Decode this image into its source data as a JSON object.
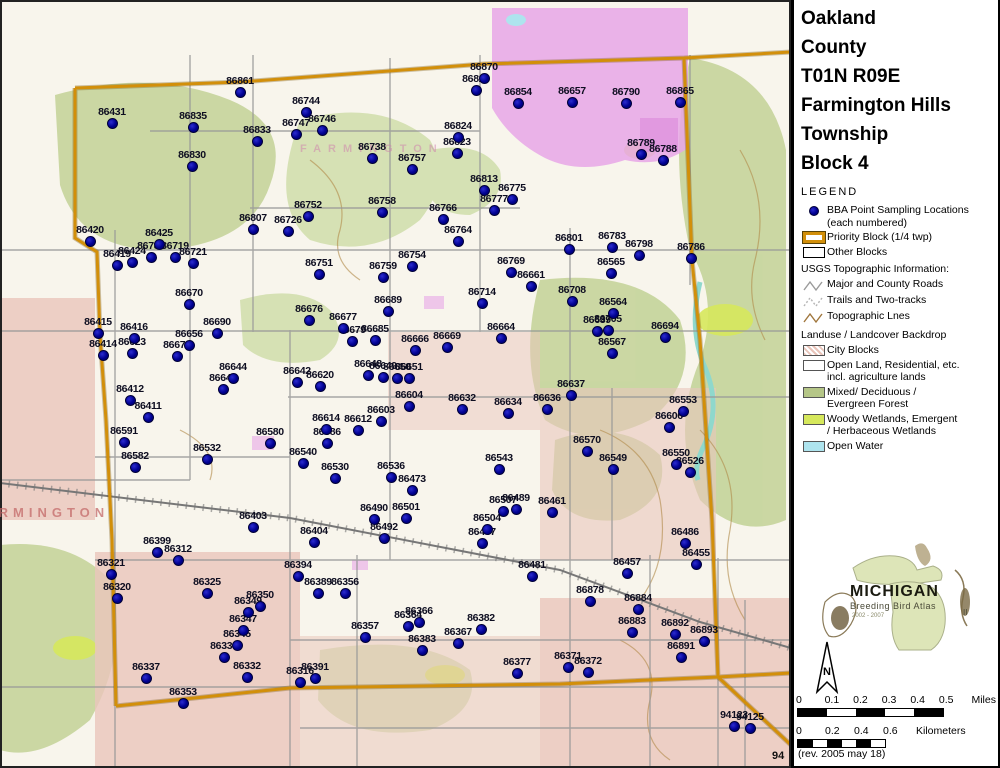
{
  "panel": {
    "title_lines": [
      "Oakland",
      "County",
      "T01N R09E",
      "Farmington Hills",
      "Township",
      "Block 4"
    ],
    "legend_heading": "LEGEND",
    "legend": {
      "items": [
        {
          "icon": "bba-point-dot",
          "lines": [
            "BBA Point Sampling Locations",
            "(each numbered)"
          ]
        },
        {
          "icon": "priority-block-swatch",
          "lines": [
            "Priority Block (1/4 twp)",
            ""
          ]
        },
        {
          "icon": "other-block-swatch",
          "lines": [
            "Other Blocks",
            ""
          ]
        }
      ]
    },
    "usgs": {
      "heading": "USGS Topographic Information:",
      "items": [
        {
          "icon": "major-roads-line",
          "label": "Major and County Roads"
        },
        {
          "icon": "trails-line",
          "label": "Trails and Two-tracks"
        },
        {
          "icon": "topographic-line",
          "label": "Topographic Lnes"
        }
      ]
    },
    "landuse": {
      "heading": "Landuse / Landcover Backdrop",
      "items": [
        {
          "swatch": "#e9c4ba",
          "pattern": "hatch",
          "lines": [
            "City Blocks",
            ""
          ]
        },
        {
          "swatch": "#ffffff",
          "pattern": "",
          "lines": [
            "Open Land, Residential, etc.",
            "incl. agriculture lands"
          ]
        },
        {
          "swatch": "#b5c687",
          "pattern": "",
          "lines": [
            "Mixed/ Deciduous /",
            "Evergreen Forest"
          ]
        },
        {
          "swatch": "#d6e85c",
          "pattern": "",
          "lines": [
            "Woody Wetlands, Emergent",
            "/ Herbaceous Wetlands"
          ]
        },
        {
          "swatch": "#aee4ee",
          "pattern": "",
          "lines": [
            "Open Water",
            ""
          ]
        }
      ]
    },
    "logo": {
      "name": "MICHIGAN",
      "sub": "Breeding Bird Atlas",
      "years": "2002 - 2007",
      "numeral": "II"
    },
    "north_label": "N",
    "scales": {
      "miles": {
        "ticks": [
          "0",
          "0.1",
          "0.2",
          "0.3",
          "0.4",
          "0.5"
        ],
        "unit": "Miles",
        "segments": 5
      },
      "km": {
        "ticks": [
          "0",
          "0.2",
          "0.4",
          "0.6"
        ],
        "unit": "Kilometers",
        "segments": 6
      }
    },
    "rev_text": "(rev. 2005 may 18)"
  },
  "map": {
    "colors": {
      "priority_border": "#d28f0a",
      "point_fill": "#000090",
      "forest": "#c5d49b",
      "wetland": "#d6e85c",
      "city": "#e9c4ba",
      "subdivision": "#e7a6e7",
      "water": "#aee4ee"
    },
    "town_label": "FARMINGTON",
    "town_label2": "FARMINGTON",
    "corner_label": "94",
    "points": [
      [
        "86431",
        112,
        123
      ],
      [
        "86861",
        240,
        92
      ],
      [
        "86835",
        193,
        127
      ],
      [
        "86833",
        257,
        141
      ],
      [
        "86744",
        306,
        112
      ],
      [
        "86746",
        322,
        130
      ],
      [
        "86747",
        296,
        134
      ],
      [
        "86738",
        372,
        158
      ],
      [
        "86830",
        192,
        166
      ],
      [
        "86870",
        484,
        78
      ],
      [
        "86826",
        476,
        90
      ],
      [
        "86854",
        518,
        103
      ],
      [
        "86657",
        572,
        102
      ],
      [
        "86790",
        626,
        103
      ],
      [
        "86865",
        680,
        102
      ],
      [
        "86824",
        458,
        137
      ],
      [
        "86757",
        412,
        169
      ],
      [
        "86823",
        457,
        153
      ],
      [
        "86789",
        641,
        154
      ],
      [
        "86788",
        663,
        160
      ],
      [
        "86813",
        484,
        190
      ],
      [
        "86775",
        512,
        199
      ],
      [
        "86777",
        494,
        210
      ],
      [
        "86766",
        443,
        219
      ],
      [
        "86764",
        458,
        241
      ],
      [
        "86758",
        382,
        212
      ],
      [
        "86752",
        308,
        216
      ],
      [
        "86807",
        253,
        229
      ],
      [
        "86726",
        288,
        231
      ],
      [
        "86420",
        90,
        241
      ],
      [
        "86425",
        159,
        244
      ],
      [
        "86719",
        175,
        257
      ],
      [
        "86419",
        117,
        265
      ],
      [
        "86424",
        132,
        262
      ],
      [
        "86785",
        151,
        257
      ],
      [
        "86721",
        193,
        263
      ],
      [
        "86751",
        319,
        274
      ],
      [
        "86759",
        383,
        277
      ],
      [
        "86754",
        412,
        266
      ],
      [
        "86769",
        511,
        272
      ],
      [
        "86661",
        531,
        286
      ],
      [
        "86801",
        569,
        249
      ],
      [
        "86783",
        612,
        247
      ],
      [
        "86798",
        639,
        255
      ],
      [
        "86786",
        691,
        258
      ],
      [
        "86565",
        611,
        273
      ],
      [
        "86670",
        189,
        304
      ],
      [
        "86714",
        482,
        303
      ],
      [
        "86689",
        388,
        311
      ],
      [
        "86676",
        309,
        320
      ],
      [
        "86677",
        343,
        328
      ],
      [
        "86708",
        572,
        301
      ],
      [
        "86415",
        98,
        333
      ],
      [
        "86416",
        134,
        338
      ],
      [
        "86690",
        217,
        333
      ],
      [
        "86656",
        189,
        345
      ],
      [
        "86671",
        177,
        356
      ],
      [
        "86623",
        132,
        353
      ],
      [
        "86685",
        375,
        340
      ],
      [
        "86679",
        352,
        341
      ],
      [
        "86664",
        501,
        338
      ],
      [
        "86666",
        415,
        350
      ],
      [
        "86669",
        447,
        347
      ],
      [
        "86564",
        613,
        313
      ],
      [
        "86639",
        597,
        331
      ],
      [
        "86705",
        608,
        330
      ],
      [
        "86694",
        665,
        337
      ],
      [
        "86567",
        612,
        353
      ],
      [
        "86414",
        103,
        355
      ],
      [
        "86644",
        233,
        378
      ],
      [
        "86647",
        223,
        389
      ],
      [
        "86642",
        297,
        382
      ],
      [
        "86620",
        320,
        386
      ],
      [
        "86648",
        368,
        375
      ],
      [
        "86649",
        383,
        377
      ],
      [
        "86650",
        397,
        378
      ],
      [
        "86651",
        409,
        378
      ],
      [
        "86637",
        571,
        395
      ],
      [
        "86636",
        547,
        409
      ],
      [
        "86412",
        130,
        400
      ],
      [
        "86411",
        148,
        417
      ],
      [
        "86604",
        409,
        406
      ],
      [
        "86632",
        462,
        409
      ],
      [
        "86634",
        508,
        413
      ],
      [
        "86603",
        381,
        421
      ],
      [
        "86614",
        326,
        429
      ],
      [
        "86612",
        358,
        430
      ],
      [
        "86580",
        270,
        443
      ],
      [
        "86586",
        327,
        443
      ],
      [
        "86553",
        683,
        411
      ],
      [
        "86606",
        669,
        427
      ],
      [
        "86591",
        124,
        442
      ],
      [
        "86582",
        135,
        467
      ],
      [
        "86532",
        207,
        459
      ],
      [
        "86570",
        587,
        451
      ],
      [
        "86549",
        613,
        469
      ],
      [
        "86550",
        676,
        464
      ],
      [
        "86526",
        690,
        472
      ],
      [
        "86540",
        303,
        463
      ],
      [
        "86530",
        335,
        478
      ],
      [
        "86536",
        391,
        477
      ],
      [
        "86543",
        499,
        469
      ],
      [
        "86473",
        412,
        490
      ],
      [
        "86507",
        503,
        511
      ],
      [
        "86489",
        516,
        509
      ],
      [
        "86490",
        374,
        519
      ],
      [
        "86501",
        406,
        518
      ],
      [
        "86504",
        487,
        529
      ],
      [
        "86467",
        482,
        543
      ],
      [
        "86461",
        552,
        512
      ],
      [
        "86403",
        253,
        527
      ],
      [
        "86404",
        314,
        542
      ],
      [
        "86492",
        384,
        538
      ],
      [
        "86486",
        685,
        543
      ],
      [
        "86455",
        696,
        564
      ],
      [
        "86457",
        627,
        573
      ],
      [
        "86481",
        532,
        576
      ],
      [
        "86399",
        157,
        552
      ],
      [
        "86312",
        178,
        560
      ],
      [
        "86321",
        111,
        574
      ],
      [
        "86320",
        117,
        598
      ],
      [
        "86394",
        298,
        576
      ],
      [
        "86356",
        345,
        593
      ],
      [
        "86389",
        318,
        593
      ],
      [
        "86325",
        207,
        593
      ],
      [
        "86350",
        260,
        606
      ],
      [
        "86349",
        248,
        612
      ],
      [
        "86347",
        243,
        630
      ],
      [
        "86345",
        237,
        645
      ],
      [
        "86334",
        224,
        657
      ],
      [
        "86332",
        247,
        677
      ],
      [
        "86337",
        146,
        678
      ],
      [
        "86353",
        183,
        703
      ],
      [
        "86366",
        419,
        622
      ],
      [
        "86364",
        408,
        626
      ],
      [
        "86357",
        365,
        637
      ],
      [
        "86383",
        422,
        650
      ],
      [
        "86367",
        458,
        643
      ],
      [
        "86382",
        481,
        629
      ],
      [
        "86377",
        517,
        673
      ],
      [
        "86316",
        300,
        682
      ],
      [
        "86391",
        315,
        678
      ],
      [
        "86371",
        568,
        667
      ],
      [
        "86372",
        588,
        672
      ],
      [
        "86878",
        590,
        601
      ],
      [
        "86884",
        638,
        609
      ],
      [
        "86883",
        632,
        632
      ],
      [
        "86892",
        675,
        634
      ],
      [
        "86893",
        704,
        641
      ],
      [
        "86891",
        681,
        657
      ],
      [
        "94123",
        734,
        726
      ],
      [
        "94125",
        750,
        728
      ]
    ]
  }
}
